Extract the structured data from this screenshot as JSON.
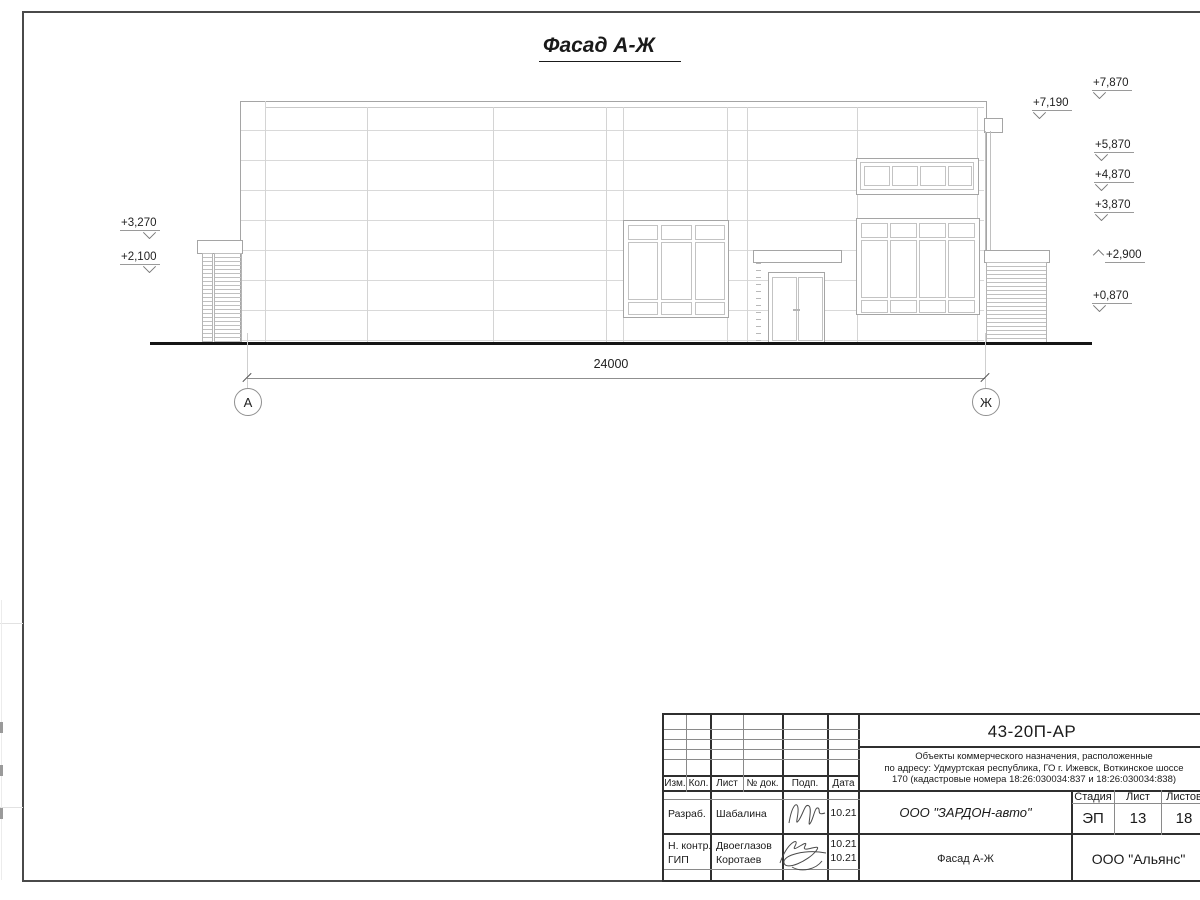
{
  "colors": {
    "paper": "#ffffff",
    "frame_line": "#4a4a4a",
    "drawing_line": "#a5a5a5",
    "faint_line": "#d9d9d9",
    "ground_line": "#151515",
    "text": "#1a1a1a"
  },
  "drawing_title": "Фасад А-Ж",
  "dimension_value": "24000",
  "axes": [
    "А",
    "Ж"
  ],
  "elevations": {
    "left": [
      "+3,270",
      "+2,100"
    ],
    "right": [
      "+7,870",
      "+7,190",
      "+5,870",
      "+4,870",
      "+3,870",
      "+2,900",
      "+0,870"
    ]
  },
  "title_block": {
    "doc_code": "43-20П-АР",
    "project_desc_lines": [
      "Объекты коммерческого назначения, расположенные",
      "по адресу: Удмуртская республика, ГО г. Ижевск, Воткинское шоссе",
      "170 (кадастровые номера 18:26:030034:837 и 18:26:030034:838)"
    ],
    "columns": [
      "Изм.",
      "Кол.",
      "Лист",
      "№ док.",
      "Подп.",
      "Дата"
    ],
    "rows": [
      {
        "role": "Разраб.",
        "name": "Шабалина",
        "date": "10.21"
      },
      {
        "role": "Н. контр.",
        "name": "Двоеглазов",
        "date": "10.21"
      },
      {
        "role": "ГИП",
        "name": "Коротаев",
        "date": "10.21"
      }
    ],
    "company": "ООО \"ЗАРДОН-авто\"",
    "stage_header": {
      "stage": "Стадия",
      "sheet": "Лист",
      "sheets": "Листов"
    },
    "stage_values": {
      "stage": "ЭП",
      "sheet": "13",
      "sheets": "18"
    },
    "sheet_title": "Фасад А-Ж",
    "org": "ООО \"Альянс\""
  }
}
